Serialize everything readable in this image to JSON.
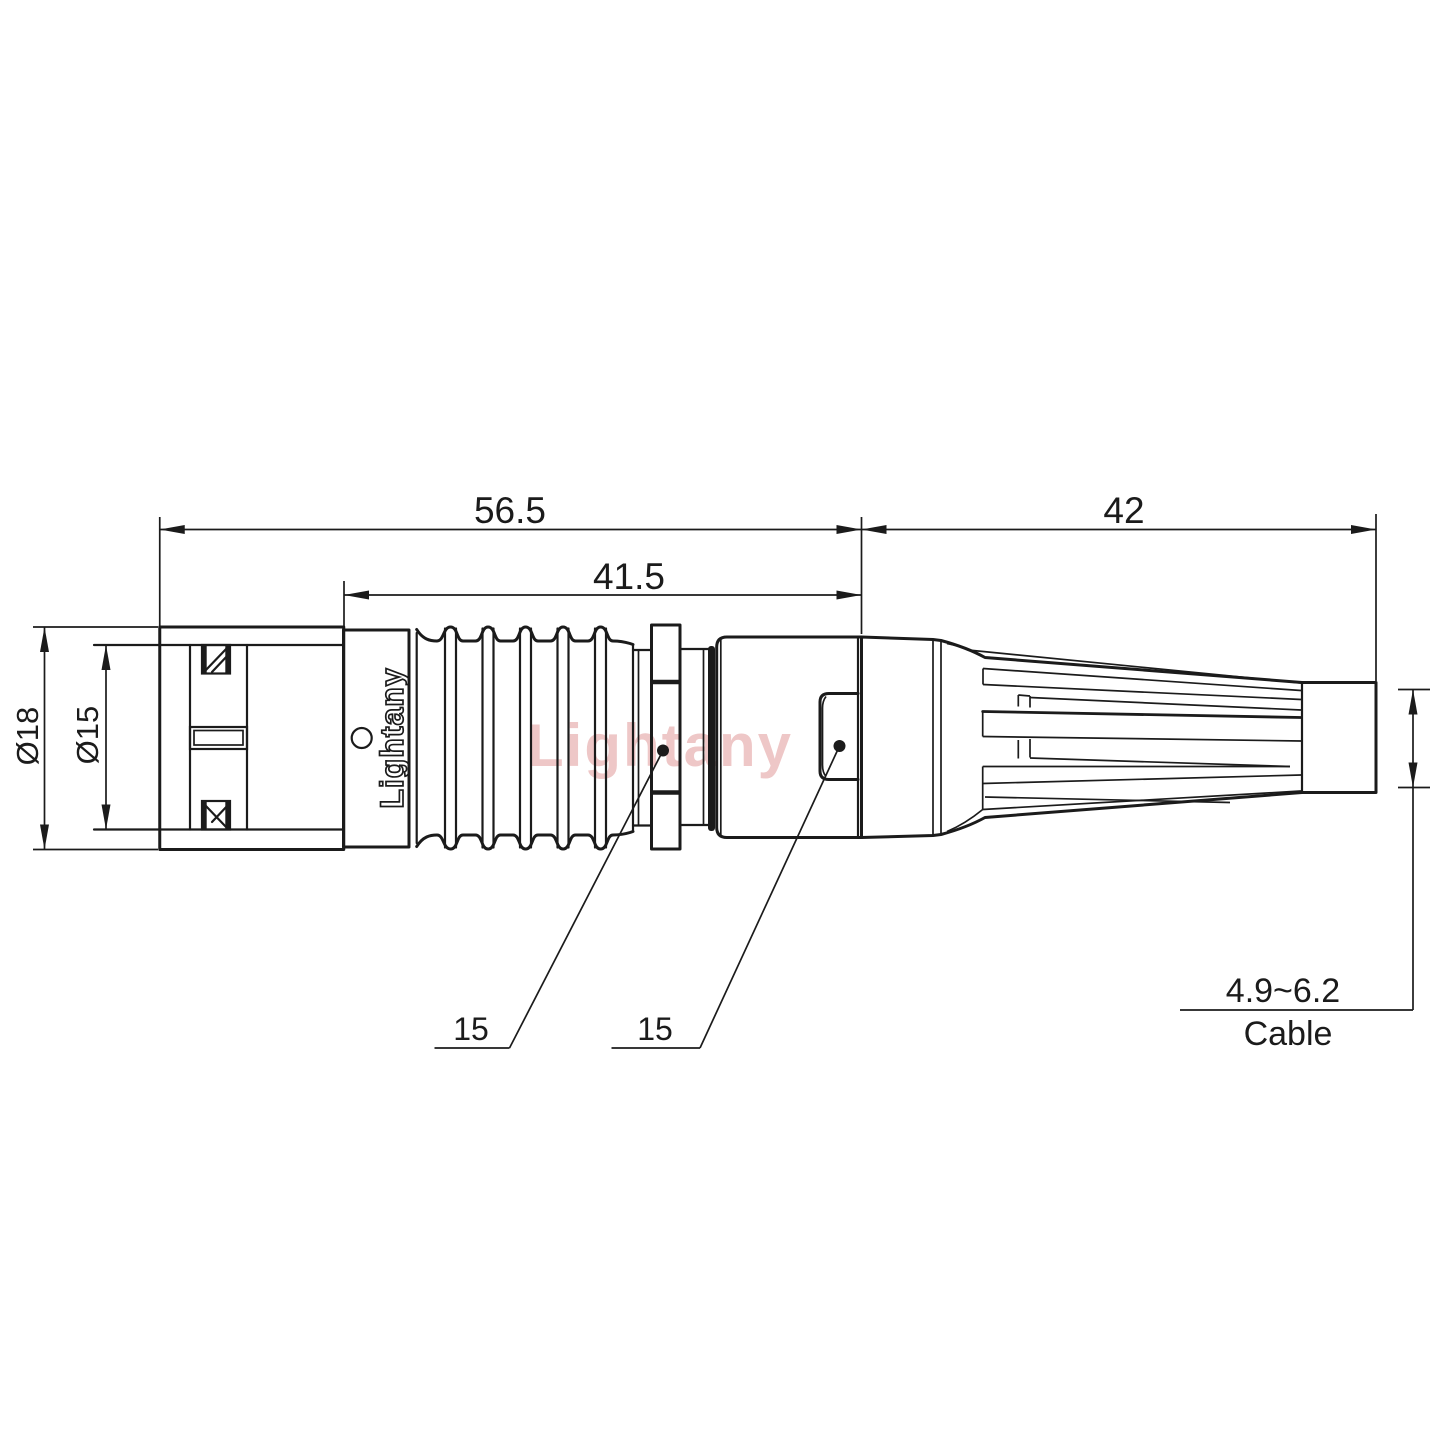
{
  "drawing": {
    "type": "technical-connector-drawing",
    "brand": "Lightany",
    "watermark": "Lightany",
    "colors": {
      "line": "#1b1b1b",
      "watermark": "#de9191",
      "background": "#ffffff"
    },
    "dimensions": {
      "total_front_length": "56.5",
      "body_length": "41.5",
      "rear_length": "42",
      "outer_diameter": "Ø18",
      "inner_diameter": "Ø15",
      "collar_leader": "15",
      "sleeve_leader": "15",
      "cable_range": "4.9~6.2",
      "cable_label": "Cable"
    }
  }
}
